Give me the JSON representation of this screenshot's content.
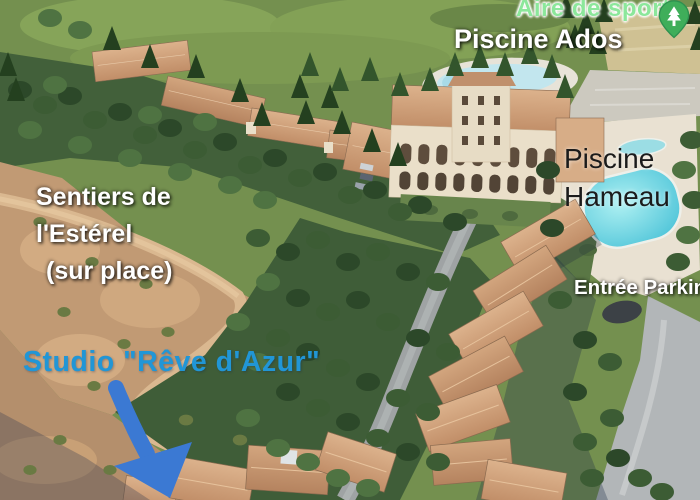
{
  "scene": {
    "labels": {
      "aire_de_sport": {
        "text": "Aire de sport",
        "color": "#8ce79b"
      },
      "piscine_ados": {
        "text": "Piscine Ados",
        "color": "#ffffff"
      },
      "piscine_hameau": {
        "line1": "Piscine",
        "line2": "Hameau",
        "color": "#1b1b1b"
      },
      "sentiers": {
        "line1": "Sentiers de",
        "line2": "l'Estérel",
        "line3": "(sur place)",
        "color": "#ffffff"
      },
      "entree_parking": {
        "text": "Entrée Parking",
        "color": "#ffffff"
      },
      "studio": {
        "text": "Studio \"Rêve d'Azur\"",
        "color": "#2196d6"
      }
    },
    "icons": {
      "park_pin_color": "#3fae5a",
      "arrow_color": "#3b79d3"
    },
    "photo_colors": {
      "grass": "#7d9a52",
      "forest": "#3f5d38",
      "scrub": "#c19a74",
      "roof": "#cda27f",
      "pool_water": "#5fd0da",
      "road": "#a7abac"
    }
  }
}
